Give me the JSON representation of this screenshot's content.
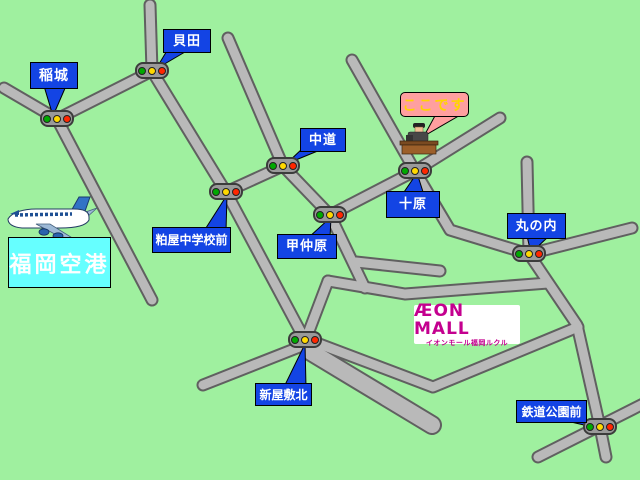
{
  "callouts": {
    "inagi": "稲城",
    "kaida": "貝田",
    "nakamichi": "中道",
    "tobaru": "十原",
    "konakabaru": "甲仲原",
    "kasuya_jhs": "粕屋中学校前",
    "marunouchi": "丸の内",
    "shinyashiki_kita": "新屋敷北",
    "tetsudo_koen_mae": "鉄道公園前"
  },
  "destination": {
    "label": "ここです"
  },
  "airport": {
    "label": "福岡空港"
  },
  "aeon_mall": {
    "name": "ÆON MALL",
    "subname": "イオンモール福岡ルクル"
  },
  "colors": {
    "background": "#9ff09f",
    "road_fill": "#b9b9b9",
    "road_edge": "#606060",
    "callout_blue": "#1344e4",
    "destination_pink": "#ff9f9f",
    "destination_text": "#ffd400",
    "airport_cyan": "#66ffff",
    "aeon_magenta": "#c4008f"
  }
}
